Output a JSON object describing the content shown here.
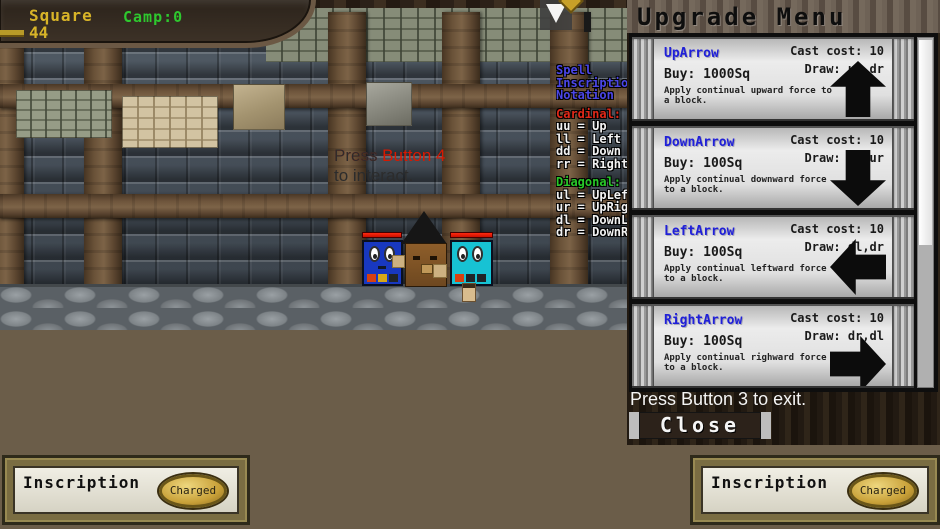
{
  "colors": {
    "banner_gold": "#d8b428",
    "camp_green": "#2ec82e",
    "spell_title_blue": "#4b46e8",
    "cardinal_red": "#e02818",
    "diagonal_green": "#28c828",
    "interact_red": "#d81800",
    "card_name_blue": "#2020d8",
    "hp_red": "#e01800",
    "block_left_blue": "#1838c0",
    "block_right_cyan": "#17c2d4"
  },
  "hud": {
    "banner": {
      "square_label": "Square",
      "square_value": "44",
      "camp": "Camp:0"
    },
    "interact": {
      "prefix": "Press ",
      "highlight": "Press Button 4",
      "line2": "to interact."
    }
  },
  "spell_notation": {
    "title_lines": [
      "Spell",
      "Inscription",
      "Notation"
    ],
    "cardinal_header": "Cardinal:",
    "cardinal": [
      "uu = Up",
      "ll = Left",
      "dd = Down",
      "rr = Right"
    ],
    "diagonal_header": "Diagonal:",
    "diagonal": [
      "ul = UpLeft",
      "ur = UpRight",
      "dl = DownLeft",
      "dr = DownRight"
    ]
  },
  "upgrade_menu": {
    "title": "Upgrade Menu",
    "cards": [
      {
        "name": "UpArrow",
        "cast": "Cast cost: 10",
        "draw": "Draw: ur,dr",
        "buy": "Buy: 1000Sq",
        "desc": "Apply continual upward force to a block.",
        "arrow_icon": "up-arrow"
      },
      {
        "name": "DownArrow",
        "cast": "Cast cost: 10",
        "draw": "Draw: dr,ur",
        "buy": "Buy: 100Sq",
        "desc": "Apply continual downward force to a block.",
        "arrow_icon": "down-arrow"
      },
      {
        "name": "LeftArrow",
        "cast": "Cast cost: 10",
        "draw": "Draw: dl,dr",
        "buy": "Buy: 100Sq",
        "desc": "Apply continual leftward force to a block.",
        "arrow_icon": "left-arrow"
      },
      {
        "name": "RightArrow",
        "cast": "Cast cost: 10",
        "draw": "Draw: dr,dl",
        "buy": "Buy: 100Sq",
        "desc": "Apply continual righward force to a block.",
        "arrow_icon": "right-arrow"
      }
    ],
    "exit_hint": "Press Button 3 to exit.",
    "close_label": "Close"
  },
  "inscriptions": {
    "left": {
      "label": "Inscription",
      "button": "Charged"
    },
    "right": {
      "label": "Inscription",
      "button": "Charged"
    }
  }
}
